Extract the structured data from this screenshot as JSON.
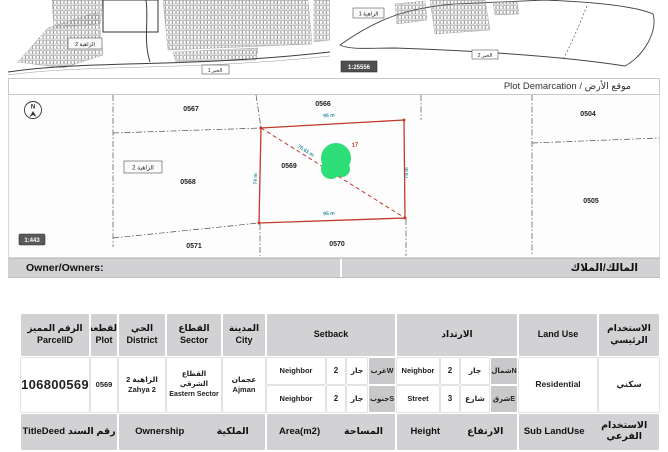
{
  "title_bar": {
    "text": "Plot Demarcation / موقع الأرض"
  },
  "mini_maps": {
    "left_area_label": "الزاهية 2",
    "left_road_label": "الخير 1",
    "right_area_label": "الزاهية 1",
    "right_road_label": "الخير 2",
    "right_scale": "1:25556"
  },
  "map": {
    "scale": "1:443",
    "north_letter": "N",
    "district_box_label": "الزاهية 2",
    "plot_labels": {
      "p0567": "0567",
      "p0566": "0566",
      "p0504": "0504",
      "p0568": "0568",
      "p0569": "0569",
      "p0505": "0505",
      "p0571": "0571",
      "p0570": "0570"
    },
    "marker_partial_text": "17",
    "dimensions": {
      "top": "95 m",
      "bottom": "95 m",
      "left": "74 m",
      "right": "74 m",
      "diagonal": "76.61 m"
    },
    "colors": {
      "highlight": "#c0392b",
      "marker": "#2ede78",
      "dimension_text": "#2b8a9e"
    }
  },
  "owner_bar": {
    "en": "Owner/Owners:",
    "ar": "المالك/الملاك"
  },
  "table": {
    "header": {
      "parcel_ar": "الرقم المميز",
      "parcel_en": "ParcelID",
      "plot_ar": "القطعة",
      "plot_en": "Plot",
      "district_ar": "الحي",
      "district_en": "District",
      "sector_ar": "القطاع",
      "sector_en": "Sector",
      "city_ar": "المدينة",
      "city_en": "City",
      "setback_en": "Setback",
      "setback_ar": "الارتداد",
      "landuse_en": "Land Use",
      "mainuse_ar": "الاستخدام الرئيسي"
    },
    "row": {
      "parcel_id": "106800569",
      "plot": "0569",
      "district_ar": "الزاهية 2",
      "district_en": "Zahya 2",
      "sector_ar": "القطاع الشرقي",
      "sector_en": "Eastern Sector",
      "city_ar": "عجمان",
      "city_en": "Ajman",
      "land_use_en": "Residential",
      "land_use_ar": "سكني"
    },
    "setbacks": [
      {
        "type_en": "Neighbor",
        "value": "2",
        "type_ar": "جار",
        "dir": "غربW"
      },
      {
        "type_en": "Neighbor",
        "value": "2",
        "type_ar": "جار",
        "dir": "شمالN"
      },
      {
        "type_en": "Neighbor",
        "value": "2",
        "type_ar": "جار",
        "dir": "جنوبS"
      },
      {
        "type_en": "Street",
        "value": "3",
        "type_ar": "شارع",
        "dir": "شرقE"
      }
    ],
    "footer": {
      "titledeed_en": "TitleDeed",
      "titledeed_ar": "رقم السند",
      "ownership_en": "Ownership",
      "ownership_ar": "الملكية",
      "area_en": "Area(m2)",
      "area_ar": "المساحة",
      "height_en": "Height",
      "height_ar": "الارتفاع",
      "sublanduse_en": "Sub LandUse",
      "sublanduse_ar": "الاستخدام الفرعي"
    }
  }
}
